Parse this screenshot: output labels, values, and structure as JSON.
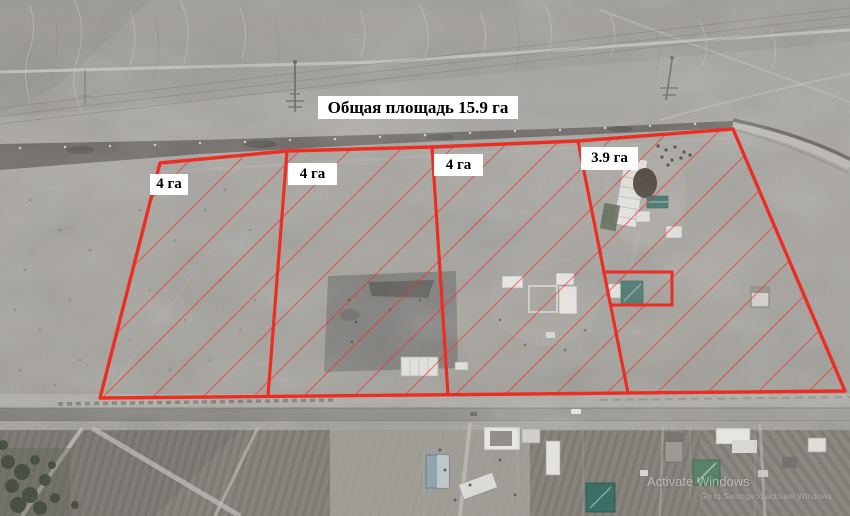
{
  "scene": {
    "title": {
      "text": "Общая площадь 15.9 га"
    },
    "plots": [
      {
        "id": "plot-1",
        "label": "4 га"
      },
      {
        "id": "plot-2",
        "label": "4 га"
      },
      {
        "id": "plot-3",
        "label": "4 га"
      },
      {
        "id": "plot-4",
        "label": "3.9 га"
      }
    ],
    "colors": {
      "boundary": "#ed2d22",
      "label_background": "#ffffff",
      "label_text": "#000000"
    }
  },
  "watermark": {
    "line1": "Activate Windows",
    "line2": "Go to Settings to activate Windows."
  }
}
